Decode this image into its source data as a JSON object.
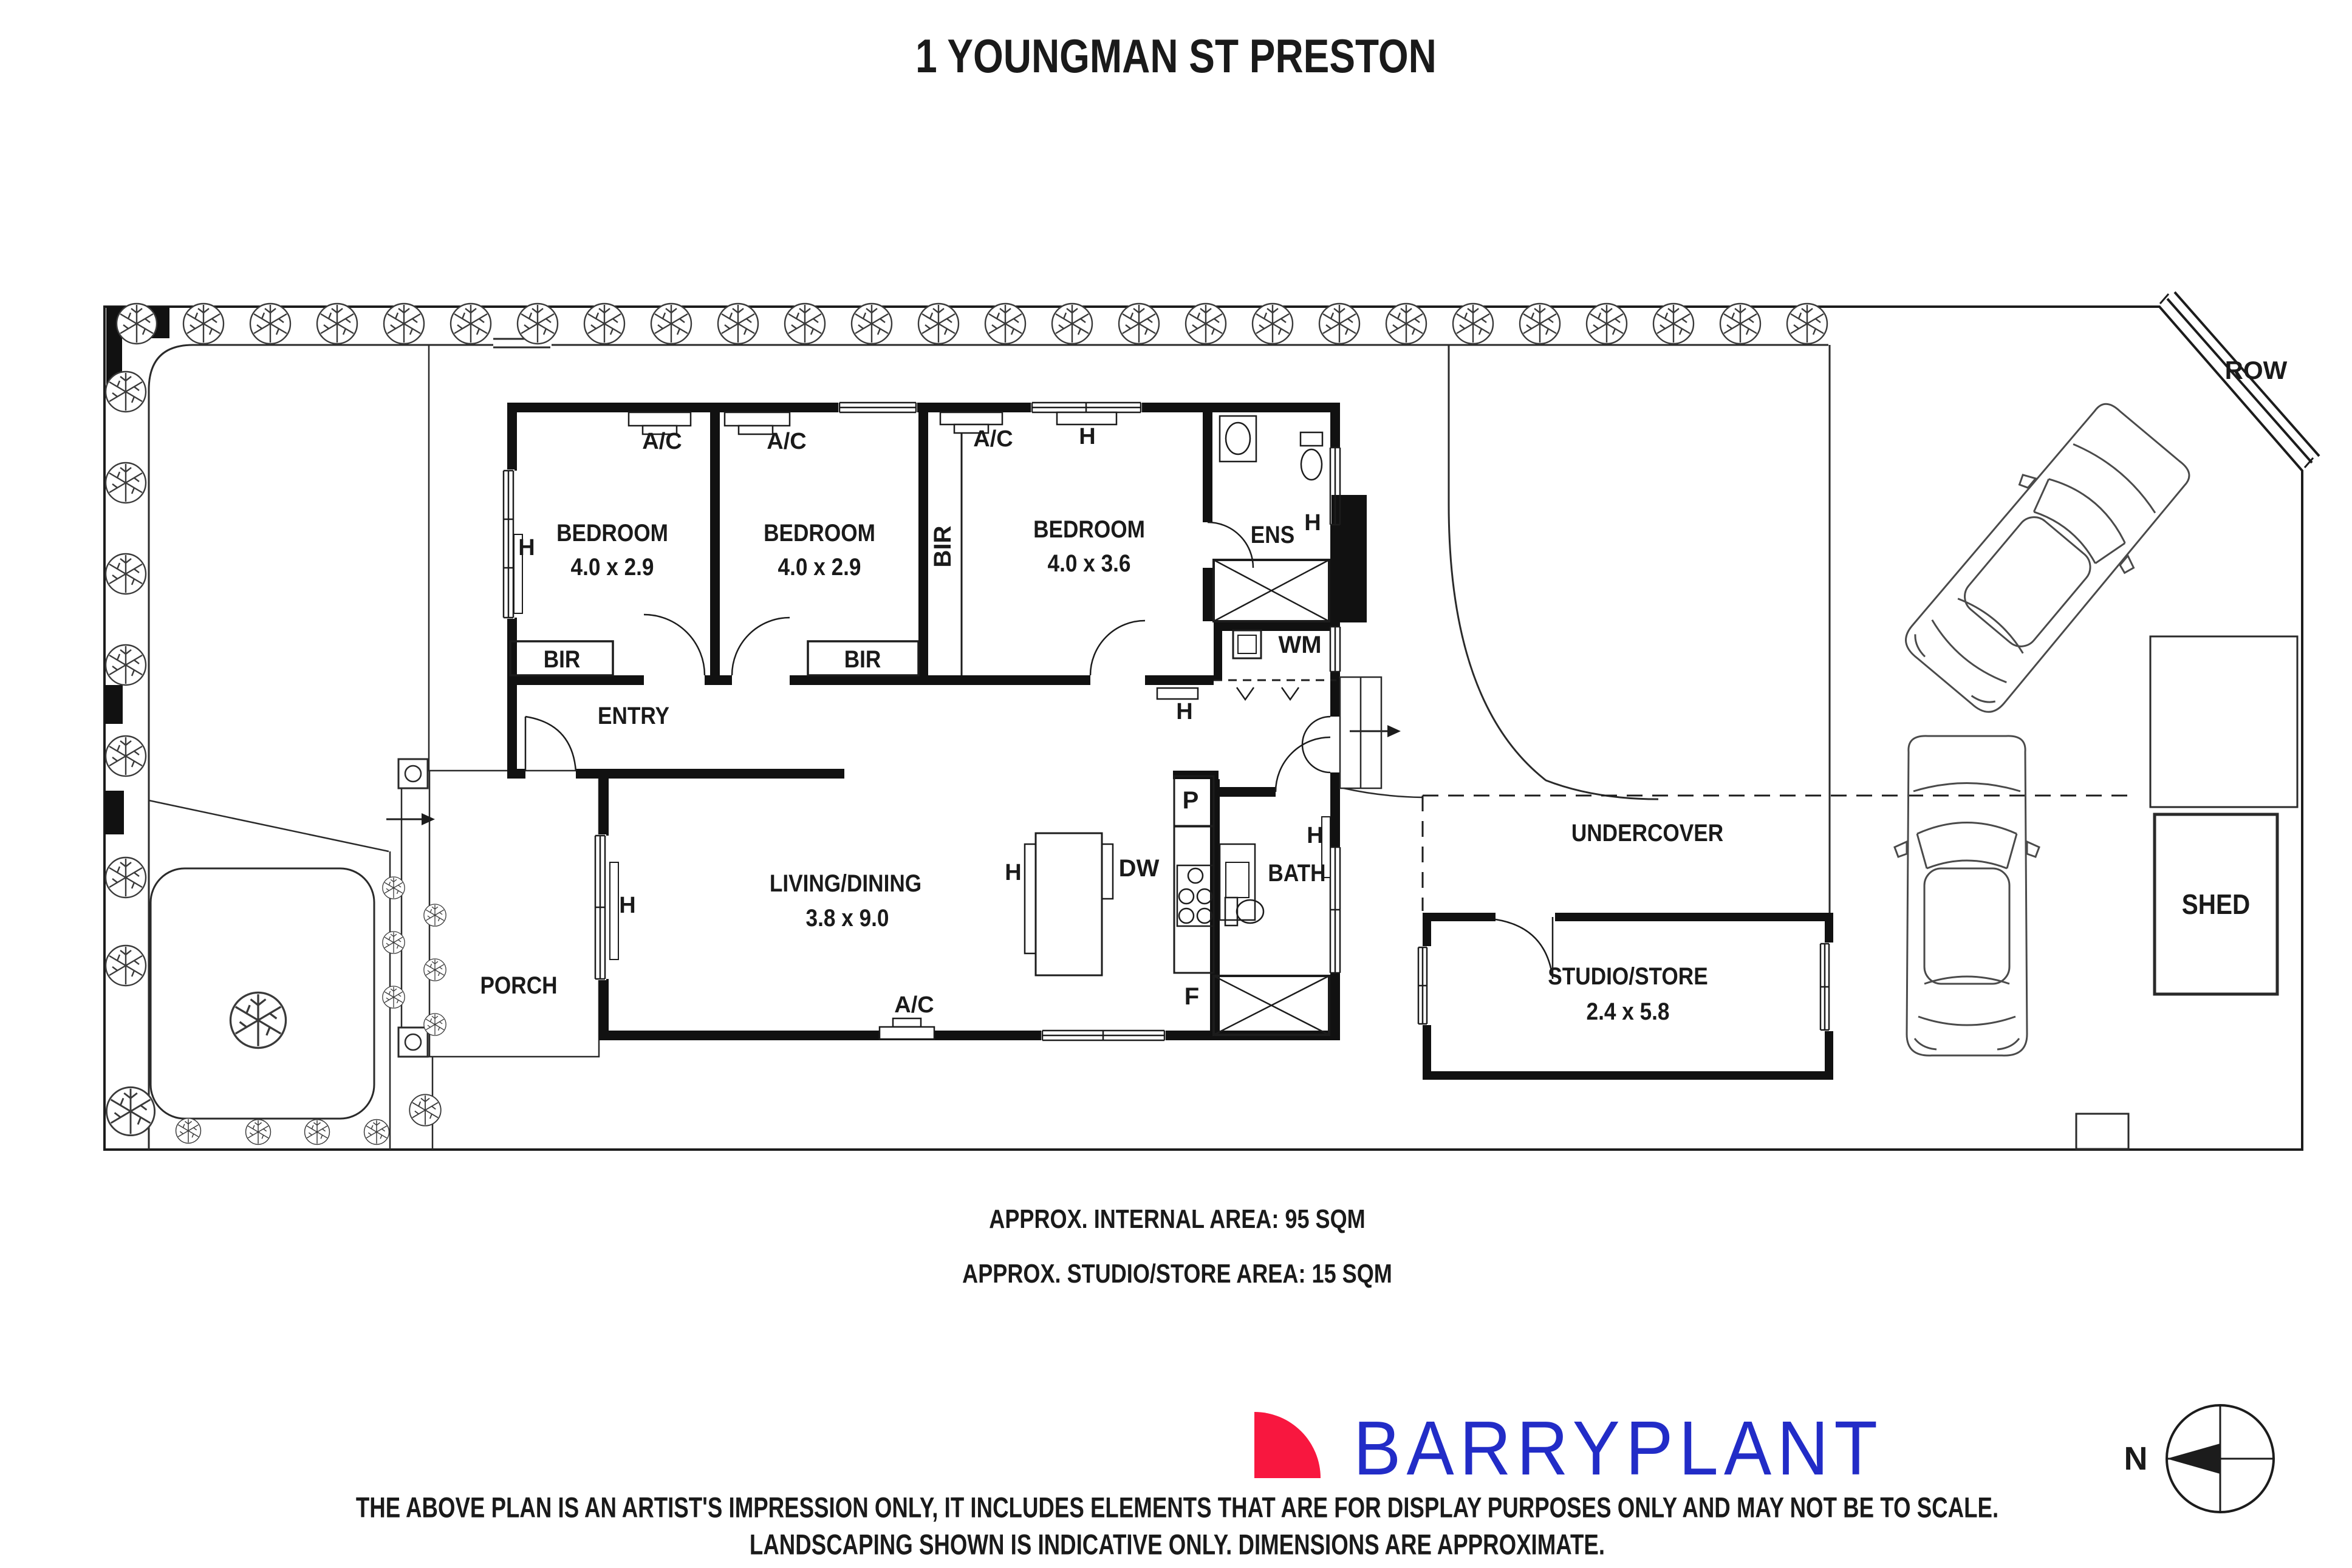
{
  "title": "1 YOUNGMAN ST PRESTON",
  "plan": {
    "rooms": {
      "bedroom1": {
        "name": "BEDROOM",
        "dims": "4.0 x 2.9"
      },
      "bedroom2": {
        "name": "BEDROOM",
        "dims": "4.0 x 2.9"
      },
      "bedroom3": {
        "name": "BEDROOM",
        "dims": "4.0 x 3.6"
      },
      "living": {
        "name": "LIVING/DINING",
        "dims": "3.8 x 9.0"
      },
      "studio": {
        "name": "STUDIO/STORE",
        "dims": "2.4 x 5.8"
      },
      "entry": "ENTRY",
      "porch": "PORCH",
      "ens": "ENS",
      "bath": "BATH",
      "undercover": "UNDERCOVER",
      "shed": "SHED",
      "row": "ROW"
    },
    "fixtures": {
      "ac": "A/C",
      "h": "H",
      "bir": "BIR",
      "wm": "WM",
      "dw": "DW",
      "p": "P",
      "f": "F"
    },
    "compass_n": "N"
  },
  "areas": {
    "internal": "APPROX. INTERNAL AREA: 95 SQM",
    "studio_store": "APPROX. STUDIO/STORE AREA: 15 SQM"
  },
  "footer": {
    "brand": "BARRYPLANT",
    "brand_color": "#222CC7",
    "brand_mark_color": "#F8173F",
    "disclaimer_line1": "THE ABOVE PLAN IS AN ARTIST'S IMPRESSION ONLY, IT INCLUDES ELEMENTS THAT ARE FOR DISPLAY PURPOSES ONLY AND MAY NOT BE TO SCALE.",
    "disclaimer_line2": "LANDSCAPING SHOWN IS INDICATIVE ONLY. DIMENSIONS ARE APPROXIMATE."
  }
}
